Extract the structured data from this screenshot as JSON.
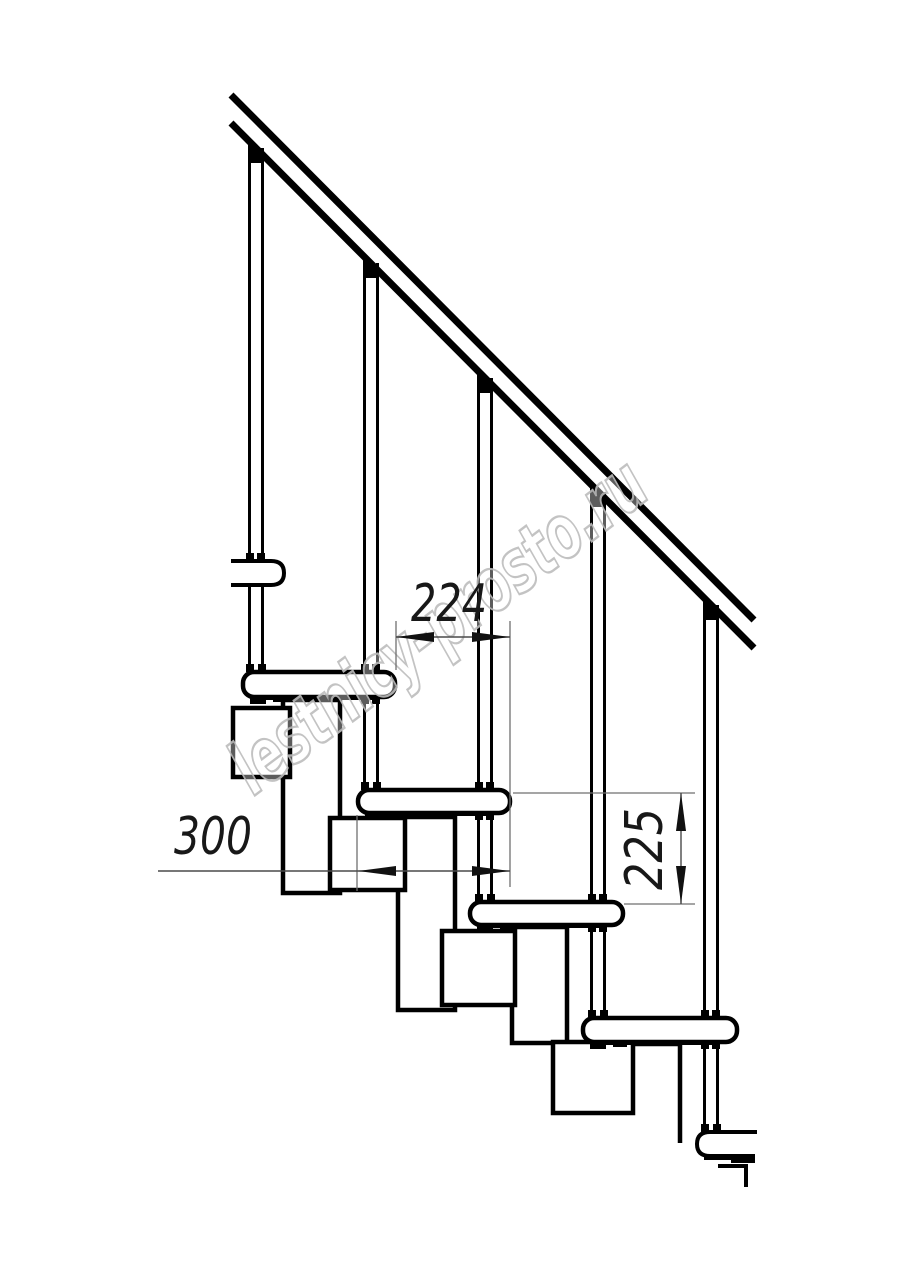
{
  "drawing": {
    "kind": "staircase-side-view-technical-drawing",
    "background": "#ffffff",
    "line_color": "#000000",
    "dim_line_color": "#6f6f6f",
    "dim_text_color": "#181818",
    "watermark": {
      "text": "lestnicy-prosto.ru",
      "color": "#bdbdbd"
    },
    "dimensions": [
      {
        "id": "d224",
        "value": "224",
        "orientation": "horizontal",
        "meaning": "step-offset"
      },
      {
        "id": "d300",
        "value": "300",
        "orientation": "horizontal",
        "meaning": "tread-depth"
      },
      {
        "id": "d225",
        "value": "225",
        "orientation": "vertical",
        "meaning": "riser-height"
      }
    ],
    "structure": {
      "handrail": true,
      "balusters": 5,
      "full_treads": 4,
      "partial_treads": 2,
      "stringer_modules": 4
    }
  }
}
